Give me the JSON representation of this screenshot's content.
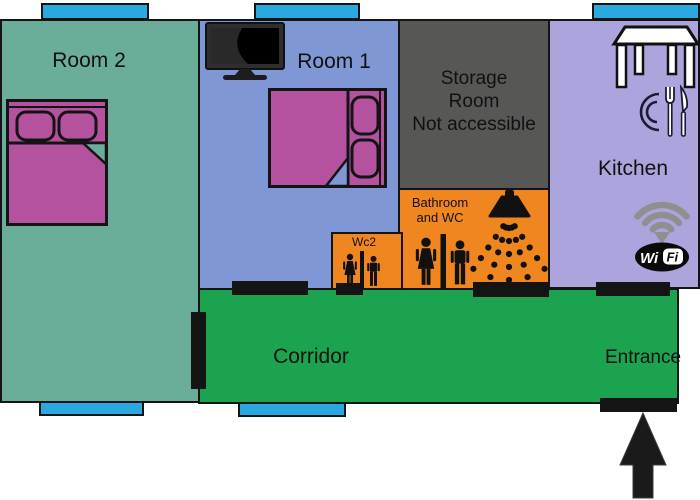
{
  "title": "Apartment floor plan",
  "palette": {
    "room2": "#6BAD9B",
    "room1": "#8097D6",
    "storage": "#575756",
    "kitchen": "#ACA4DD",
    "wet_room_orange": "#F0861F",
    "corridor": "#1CA350",
    "window_cyan": "#29A9DF",
    "door_black": "#141414",
    "bed_magenta": "#B5529F",
    "wifi_gray": "#8F8F8F"
  },
  "rooms": {
    "room2": {
      "label": "Room 2"
    },
    "room1": {
      "label": "Room 1"
    },
    "storage": {
      "lines": [
        "Storage",
        "Room",
        "Not accessible"
      ]
    },
    "bathroom": {
      "lines": [
        "Bathroom",
        "and WC"
      ]
    },
    "wc2": {
      "label": "Wc2"
    },
    "kitchen": {
      "label": "Kitchen"
    },
    "corridor": {
      "label": "Corridor"
    },
    "entrance": {
      "label": "Entrance"
    }
  },
  "wifi_logo": {
    "wi": "Wi",
    "fi": "Fi"
  },
  "icons": {
    "tv": "tv-icon",
    "bed_room2": "double-bed-icon",
    "bed_room1": "double-bed-icon",
    "dining_table": "dining-table-icon",
    "plate_cutlery": "plate-cutlery-icon",
    "wifi": "wifi-icon",
    "shower": "shower-icon",
    "bathroom_figures": "man-woman-icon",
    "wc2_figures": "man-woman-icon",
    "entrance_arrow": "up-arrow-icon"
  }
}
